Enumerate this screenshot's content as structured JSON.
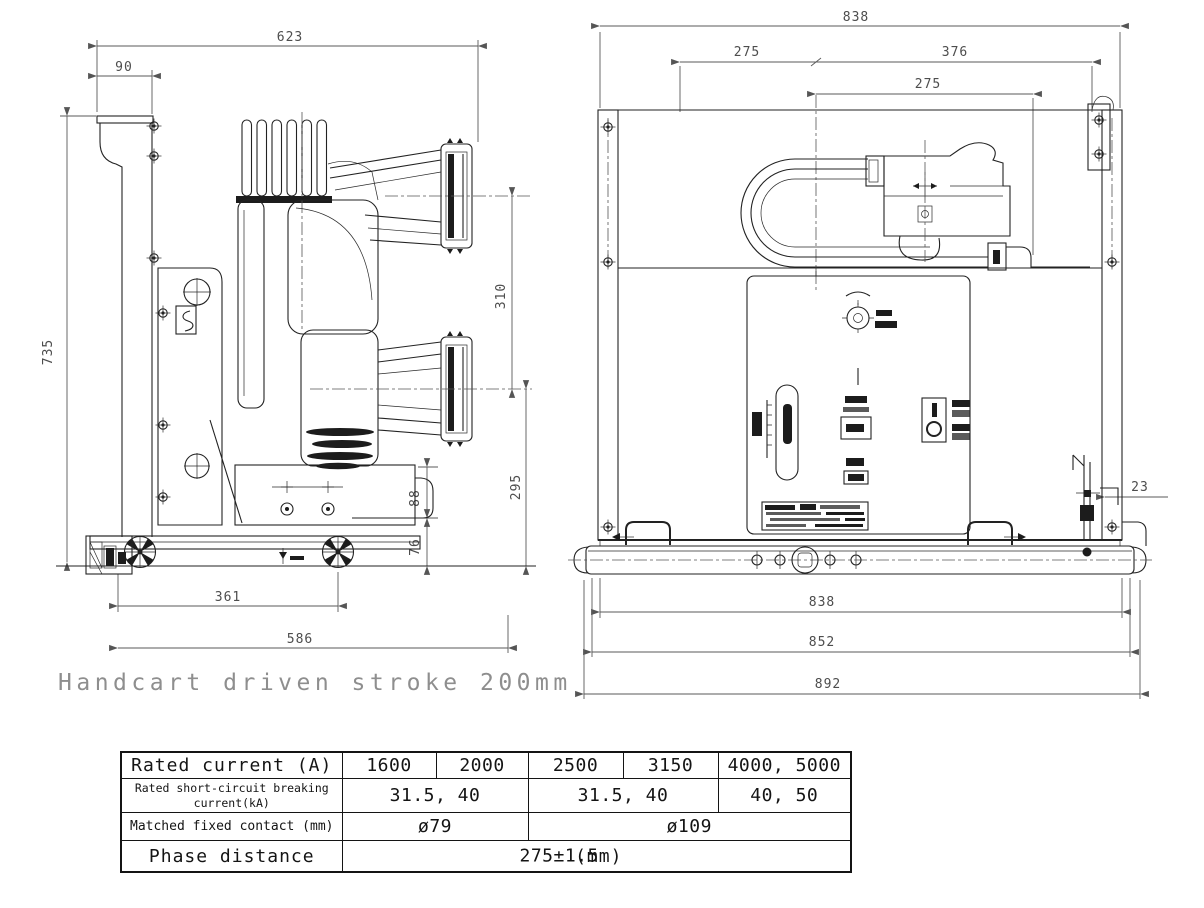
{
  "caption": "Handcart driven stroke 200mm",
  "side_view": {
    "dims": {
      "total_depth_top": "623",
      "top_bracket_width": "90",
      "overall_height": "735",
      "pole_center_spacing": "310",
      "lower_pole_center_height": "295",
      "support_plate_height": "88",
      "base_height": "76",
      "wheel_base": "361",
      "chassis_depth": "586"
    }
  },
  "front_view": {
    "dims": {
      "frame_width": "838",
      "center_to_left": "275",
      "center_to_right": "376",
      "phase_distance": "275",
      "side_offset": "23",
      "bottom_inner_width": "838",
      "bottom_middle_width": "852",
      "bottom_overall_width": "892"
    }
  },
  "spec_table": {
    "rated_current": {
      "label": "Rated current (A)",
      "values": [
        "1600",
        "2000",
        "2500",
        "3150",
        "4000, 5000"
      ]
    },
    "breaking_current": {
      "label_line1": "Rated short-circuit breaking",
      "label_line2": "current(kA)",
      "values": [
        "31.5, 40",
        "31.5, 40",
        "40, 50"
      ]
    },
    "fixed_contact": {
      "label": "Matched fixed contact (mm)",
      "values": [
        "ø79",
        "ø109"
      ]
    },
    "phase_distance": {
      "label": "Phase distance",
      "unit": "(mm)",
      "value": "275±1.5"
    }
  }
}
